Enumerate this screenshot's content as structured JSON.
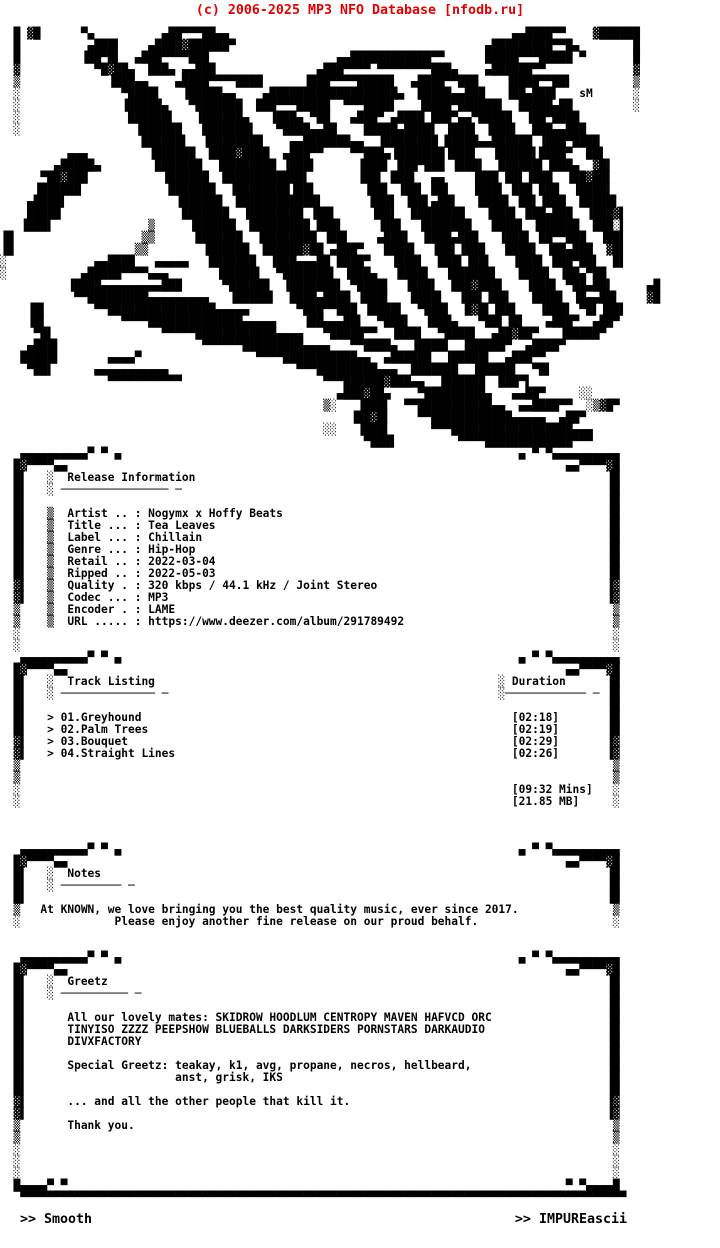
{
  "header": {
    "copyright": "(c) 2006-2025 MP3 NFO Database [nfodb.ru]"
  },
  "colors": {
    "watermark_red": "#e30000",
    "ink": "#000000",
    "paper": "#ffffff"
  },
  "logo": {
    "signature": "sM",
    "lines": [
      [
        [
          2,
          "█"
        ],
        [
          4,
          "▓█"
        ],
        [
          12,
          "▀▄"
        ],
        [
          24,
          "▄██▀▀▀██▄▄"
        ],
        [
          76,
          "▄▄████▀▀"
        ],
        [
          88,
          "▓██████"
        ]
      ],
      [
        [
          2,
          "█"
        ],
        [
          13,
          "▄███▌"
        ],
        [
          22,
          "▄████▓██████▀"
        ],
        [
          72,
          "▄█████████▀▀█▄"
        ],
        [
          94,
          "█"
        ]
      ],
      [
        [
          2,
          "█"
        ],
        [
          12,
          "▐██▀█▌"
        ],
        [
          20,
          "▄███▀▀▀▀███"
        ],
        [
          50,
          "▄▄████████████▀▀"
        ],
        [
          72,
          "█████▀▀▀█████"
        ],
        [
          86,
          "▀"
        ],
        [
          94,
          "█"
        ]
      ],
      [
        [
          2,
          "▓"
        ],
        [
          14,
          "▀█▓██▄"
        ],
        [
          22,
          "███▄ ▄▄███"
        ],
        [
          47,
          "▄███▀▀▀▀ ▀▀▀▀▀▀▀▀███▄"
        ],
        [
          72,
          "▄██████▀▀"
        ],
        [
          94,
          "▓"
        ]
      ],
      [
        [
          2,
          "▒"
        ],
        [
          16,
          "▐███▄▄"
        ],
        [
          26,
          "▄████▀▀▀▀████"
        ],
        [
          45,
          "▐███▀▀▀▀█████▌"
        ],
        [
          61,
          "▄████▀▀███"
        ],
        [
          75,
          "▐████▀▀██▌"
        ],
        [
          94,
          "▒"
        ]
      ],
      [
        [
          2,
          "░"
        ],
        [
          18,
          "▀████▌"
        ],
        [
          27,
          "▐█████▄▄"
        ],
        [
          39,
          "▄███████████████████▄"
        ],
        [
          62,
          "█████▄▄███"
        ],
        [
          75,
          "▐██▄███▌"
        ],
        [
          86,
          "sM"
        ],
        [
          94,
          "░"
        ]
      ],
      [
        [
          2,
          "░"
        ],
        [
          18,
          "▐█████▄"
        ],
        [
          28,
          "▀███████"
        ],
        [
          38,
          "███▀▀▀█████"
        ],
        [
          51,
          "▀▀▀████▌"
        ],
        [
          62,
          "▐████▀██████▌"
        ],
        [
          77,
          "█████▄██"
        ],
        [
          94,
          "░"
        ]
      ],
      [
        [
          2,
          "░"
        ],
        [
          19,
          "██████▌"
        ],
        [
          29,
          "▐██████▄"
        ],
        [
          40,
          "▐███▄ ▀██"
        ],
        [
          52,
          "▄███▀ ▄████"
        ],
        [
          64,
          "███▀▄▄▀█████"
        ],
        [
          78,
          "▐██▀████"
        ]
      ],
      [
        [
          2,
          "░"
        ],
        [
          20,
          "▐██████"
        ],
        [
          30,
          "███████▌"
        ],
        [
          41,
          "▀████▄▄██"
        ],
        [
          54,
          "█████▄████▌"
        ],
        [
          66,
          "▐███▌ ▐███▌"
        ],
        [
          79,
          "███▄▄███"
        ]
      ],
      [
        [
          21,
          "██████▌"
        ],
        [
          30,
          "▐████████"
        ],
        [
          43,
          "▄▄███████▄▄"
        ],
        [
          56,
          "▐████████"
        ],
        [
          66,
          "█████▄▄██████"
        ],
        [
          80,
          "▐███▀████"
        ]
      ],
      [
        [
          10,
          "▄▄▄"
        ],
        [
          22,
          "▐██████"
        ],
        [
          31,
          "████▓████"
        ],
        [
          42,
          "▄███▀▀"
        ],
        [
          52,
          "▀▀███▄"
        ],
        [
          58,
          "▐███████"
        ],
        [
          66,
          "▐███▌"
        ],
        [
          73,
          "▐█████▌"
        ],
        [
          80,
          "████▀"
        ],
        [
          87,
          "██▌"
        ]
      ],
      [
        [
          8,
          "▄█████▄"
        ],
        [
          23,
          "███████"
        ],
        [
          32,
          "▐████████"
        ],
        [
          42,
          "▐███▌"
        ],
        [
          53,
          "▐███▌"
        ],
        [
          59,
          "███▀███"
        ],
        [
          67,
          "▐███▌"
        ],
        [
          74,
          "██████▌"
        ],
        [
          81,
          "▐███▄"
        ],
        [
          88,
          "▓█▌"
        ]
      ],
      [
        [
          6,
          "▀██▓███"
        ],
        [
          24,
          "▐██████"
        ],
        [
          33,
          "█████████"
        ],
        [
          42,
          "███▌"
        ],
        [
          53,
          "▐██▌"
        ],
        [
          58,
          "███▌"
        ],
        [
          64,
          "▄▄"
        ],
        [
          70,
          "▐███"
        ],
        [
          75,
          "██▌▐███"
        ],
        [
          84,
          "▐██▓██▌"
        ]
      ],
      [
        [
          5,
          "▐██████"
        ],
        [
          25,
          "███████"
        ],
        [
          34,
          "▐████████"
        ],
        [
          43,
          "▐██▌"
        ],
        [
          54,
          "▐██▌"
        ],
        [
          59,
          "▐██▌"
        ],
        [
          64,
          "██▌"
        ],
        [
          70,
          "▐███▌"
        ],
        [
          76,
          "███ ███"
        ],
        [
          85,
          "▐████▌"
        ]
      ],
      [
        [
          4,
          "▄████▌"
        ],
        [
          26,
          "▐██████"
        ],
        [
          35,
          "█████████"
        ],
        [
          44,
          "███▌"
        ],
        [
          55,
          "███▌"
        ],
        [
          60,
          "▐██▌"
        ],
        [
          64,
          "▄██▌"
        ],
        [
          71,
          "████▌"
        ],
        [
          77,
          "██▌▐███"
        ],
        [
          86,
          "█████▌"
        ]
      ],
      [
        [
          4,
          "█████"
        ],
        [
          27,
          "███████"
        ],
        [
          36,
          "▐████████"
        ],
        [
          46,
          "▐██▌"
        ],
        [
          55,
          "▐██▌"
        ],
        [
          61,
          "████████"
        ],
        [
          72,
          "▐███▌"
        ],
        [
          78,
          "███▄███"
        ],
        [
          87,
          "▐███▓▌"
        ]
      ],
      [
        [
          3,
          "▐███▌"
        ],
        [
          22,
          "▒"
        ],
        [
          28,
          "▐██████"
        ],
        [
          37,
          "█████████"
        ],
        [
          47,
          "███▌"
        ],
        [
          56,
          "▐██▌"
        ],
        [
          62,
          "▐███████"
        ],
        [
          73,
          "████▌"
        ],
        [
          79,
          "▐██████"
        ],
        [
          88,
          "███░▌"
        ]
      ],
      [
        [
          0,
          "▐█"
        ],
        [
          21,
          "▒▒"
        ],
        [
          29,
          "███████"
        ],
        [
          38,
          "▐████████"
        ],
        [
          48,
          "▐██▌"
        ],
        [
          56,
          "▄███▌"
        ],
        [
          63,
          "████▄███"
        ],
        [
          74,
          "▐███▌"
        ],
        [
          80,
          "██▀▀███"
        ],
        [
          89,
          "▐██▌"
        ]
      ],
      [
        [
          0,
          "▐█"
        ],
        [
          20,
          "▒▒"
        ],
        [
          30,
          "▐██████"
        ],
        [
          39,
          "██████▓██"
        ],
        [
          49,
          "▄███▀"
        ],
        [
          57,
          "████▌"
        ],
        [
          64,
          "▐██▌▐███"
        ],
        [
          75,
          "████▌"
        ],
        [
          81,
          "▐██▄███"
        ],
        [
          90,
          "▓█▌"
        ]
      ],
      [
        [
          0,
          "░"
        ],
        [
          14,
          "▄▄████"
        ],
        [
          23,
          "▄▄▄▄▄"
        ],
        [
          31,
          "███████"
        ],
        [
          40,
          "▐███▄▄▄██"
        ],
        [
          50,
          "████▀"
        ],
        [
          58,
          "▐███▌"
        ],
        [
          65,
          "███▌▐██▌"
        ],
        [
          76,
          "▐███▌"
        ],
        [
          82,
          "███▀██▌"
        ],
        [
          91,
          "█▌"
        ]
      ],
      [
        [
          0,
          "░"
        ],
        [
          12,
          "▄█████▀▀▀▀▄▄▄"
        ],
        [
          32,
          "▐█████▌"
        ],
        [
          41,
          "▀███████▌"
        ],
        [
          51,
          "▐███▄"
        ],
        [
          59,
          "████▌"
        ],
        [
          66,
          "▐██████▌"
        ],
        [
          77,
          "████▌"
        ],
        [
          83,
          "▐██▄▀██"
        ]
      ],
      [
        [
          10,
          "▐████▄▄▄▄▄▄▄▄▄███"
        ],
        [
          33,
          "▀██████"
        ],
        [
          42,
          "▐███████▌"
        ],
        [
          52,
          "▀████▌"
        ],
        [
          60,
          "▐███▌"
        ],
        [
          67,
          "███▓███▌"
        ],
        [
          78,
          "▐███▌"
        ],
        [
          84,
          "▀██▄██▌"
        ],
        [
          96,
          "▄█"
        ]
      ],
      [
        [
          11,
          "▀▀█████████▄▄▄▄▄▄▄▄▄"
        ],
        [
          34,
          "▐█████▌"
        ],
        [
          43,
          "████▄████"
        ],
        [
          53,
          "▐███▌"
        ],
        [
          61,
          "████▌"
        ],
        [
          68,
          "▐██▌▐██▌"
        ],
        [
          79,
          "████▌"
        ],
        [
          85,
          "▐█▄▄██▌"
        ],
        [
          96,
          "▓█"
        ]
      ],
      [
        [
          4,
          "▐█▌"
        ],
        [
          14,
          "▀▀████████████████▄▄▄▄▄"
        ],
        [
          44,
          "▀███▀▀███"
        ],
        [
          54,
          "▐████▌"
        ],
        [
          62,
          "▀███▌"
        ],
        [
          69,
          "█▓█▌▐██▌"
        ],
        [
          80,
          "▐███▌"
        ],
        [
          86,
          "▀█▌▐██▌"
        ]
      ],
      [
        [
          4,
          "▐█▌"
        ],
        [
          18,
          "▀▀▀▀██████████████▄▄▄▄▄"
        ],
        [
          45,
          "▐██▄▄▄██▌"
        ],
        [
          56,
          "▀███▌"
        ],
        [
          63,
          "▐███▄"
        ],
        [
          71,
          "▀██▌▐█▌"
        ],
        [
          81,
          "▄███▀"
        ],
        [
          88,
          "▄██▀"
        ]
      ],
      [
        [
          5,
          "▀█▌"
        ],
        [
          24,
          "▀▀▀▀▀████████████▄▄▄▄"
        ],
        [
          48,
          "▀█████▀▀"
        ],
        [
          58,
          "▐███▌"
        ],
        [
          65,
          "▀████▌"
        ],
        [
          73,
          "▄██▓██▀"
        ],
        [
          83,
          "▐█████▀"
        ]
      ],
      [
        [
          4,
          "▄███▌"
        ],
        [
          30,
          "▀▀▀▀▀▀█████████▄▄▄▄"
        ],
        [
          52,
          "▀▀████▄"
        ],
        [
          61,
          "▐████▌"
        ],
        [
          69,
          "██████▀"
        ],
        [
          78,
          "▄████▀"
        ]
      ],
      [
        [
          3,
          "█████▌"
        ],
        [
          16,
          "▄▄▄▄▀"
        ],
        [
          38,
          "▀▀▀▀███████████▄▄"
        ],
        [
          57,
          "▄██████"
        ],
        [
          66,
          "▐█████▌"
        ],
        [
          75,
          "▄███▀▀"
        ]
      ],
      [
        [
          4,
          "▀██▌"
        ],
        [
          14,
          "▄▄▄▄▄▄▄▄▄▄▄"
        ],
        [
          44,
          "▀▀▀█████████▄▄▄"
        ],
        [
          61,
          "███████"
        ],
        [
          70,
          "▐█████▌"
        ],
        [
          79,
          "▀█▌"
        ]
      ],
      [
        [
          16,
          "▀▀▀▀▀▀▀▀▀▀▀"
        ],
        [
          48,
          "▀▀▀██████▓███▄▄"
        ],
        [
          65,
          "▐██████"
        ],
        [
          74,
          "███▀▌"
        ]
      ],
      [
        [
          50,
          "▄███▓██▄"
        ],
        [
          62,
          "▀█████████▄"
        ],
        [
          76,
          "▄▄██▀"
        ],
        [
          86,
          "░░"
        ]
      ],
      [
        [
          48,
          "▒░"
        ],
        [
          53,
          "▐███▌"
        ],
        [
          60,
          "▀▀███████████▄▄"
        ],
        [
          77,
          "▄▄████▀▀"
        ],
        [
          87,
          "░▒▓█▀"
        ]
      ],
      [
        [
          52,
          "▐██▓█▌"
        ],
        [
          62,
          "▀▀████████████▄▄▄▄▄"
        ],
        [
          83,
          "▄██▀"
        ]
      ],
      [
        [
          48,
          "░░"
        ],
        [
          53,
          "▐███▌"
        ],
        [
          64,
          "▀▀▀██████████████████▄▄▄"
        ]
      ],
      [
        [
          54,
          "▀███▌"
        ],
        [
          68,
          "▀▀▀▀█████████████▀▀▀"
        ]
      ]
    ]
  },
  "release": {
    "title": "Release Information",
    "underline": "──────────────── ─",
    "fields": [
      {
        "label": "Artist",
        "value": "Nogymx x Hoffy Beats"
      },
      {
        "label": "Title",
        "value": "Tea Leaves"
      },
      {
        "label": "Label",
        "value": "Chillain"
      },
      {
        "label": "Genre",
        "value": "Hip-Hop"
      },
      {
        "label": "Retail",
        "value": "2022-03-04"
      },
      {
        "label": "Ripped",
        "value": "2022-05-03"
      },
      {
        "label": "Quality",
        "value": "320 kbps / 44.1 kHz / Joint Stereo"
      },
      {
        "label": "Codec",
        "value": "MP3"
      },
      {
        "label": "Encoder",
        "value": "LAME"
      },
      {
        "label": "URL",
        "value": "https://www.deezer.com/album/291789492"
      }
    ]
  },
  "tracks": {
    "title": "Track Listing",
    "underline": "────────────── ─",
    "duration_title": "Duration",
    "duration_underline": "──────────── ─",
    "list": [
      {
        "num": "01",
        "name": "Greyhound",
        "duration": "[02:18]"
      },
      {
        "num": "02",
        "name": "Palm Trees",
        "duration": "[02:19]"
      },
      {
        "num": "03",
        "name": "Bouquet",
        "duration": "[02:29]"
      },
      {
        "num": "04",
        "name": "Straight Lines",
        "duration": "[02:26]"
      }
    ],
    "total_time": "[09:32 Mins]",
    "total_size": "[21.85 MB]"
  },
  "notes": {
    "title": "Notes",
    "underline": "───────── ─",
    "lines": [
      "At KNOWN, we love bringing you the best quality music, ever since 2017.",
      "           Please enjoy another fine release on our proud behalf."
    ]
  },
  "greetz": {
    "title": "Greetz",
    "underline": "────────── ─",
    "lines": [
      "All our lovely mates: SKIDROW HOODLUM CENTROPY MAVEN HAFVCD ORC",
      "TINYISO ZZZZ PEEPSHOW BLUEBALLS DARKSIDERS PORNSTARS DARKAUDIO",
      "DIVXFACTORY",
      "",
      "Special Greetz: teakay, k1, avg, propane, necros, hellbeard,",
      "                anst, grisk, IKS",
      "",
      "... and all the other people that kill it.",
      "",
      "Thank you."
    ]
  },
  "footer": {
    "left": ">> Smooth",
    "right": ">> IMPUREascii"
  }
}
